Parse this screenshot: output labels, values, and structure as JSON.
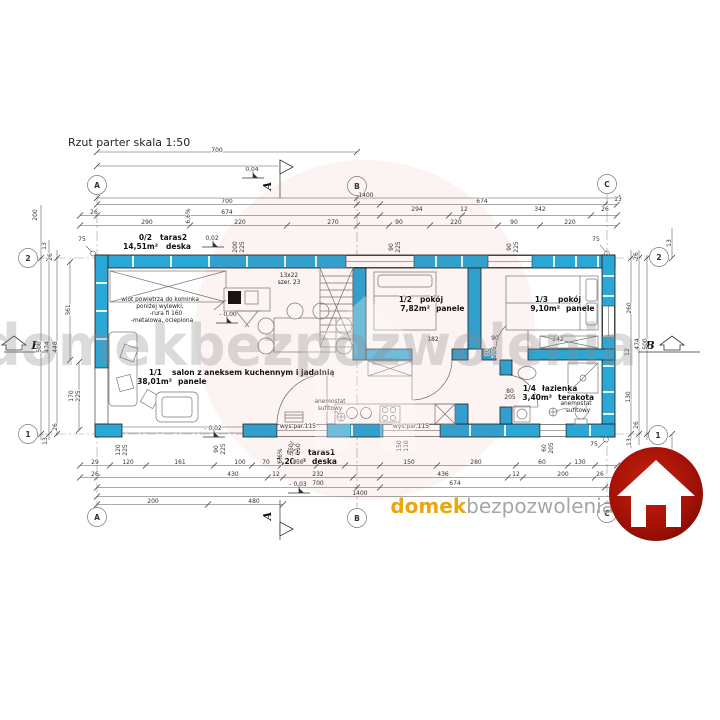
{
  "title": "Rzut parter skala 1:50",
  "watermark": {
    "text": "domekbezpozwolenia"
  },
  "logo": {
    "brand_orange": "domek",
    "brand_gray": "bezpozwolenia"
  },
  "colors": {
    "wall": "#2BA7D6",
    "logo_red": "#A31106",
    "brand_orange": "#E9A712",
    "brand_gray": "#A6A6A6"
  },
  "axes": {
    "a": "A",
    "b": "B",
    "c": "C",
    "one": "1",
    "two": "2",
    "section": "A",
    "side": "B"
  },
  "rooms": [
    {
      "id": "0/2",
      "name": "taras2",
      "area": "14,51m²",
      "floor": "deska"
    },
    {
      "id": "1/1",
      "name": "salon z aneksem kuchennym i jadalnią",
      "area": "38,01m²",
      "floor": "panele"
    },
    {
      "id": "1/2",
      "name": "pokój",
      "area": "7,82m²",
      "floor": "panele"
    },
    {
      "id": "1/3",
      "name": "pokój",
      "area": "9,10m²",
      "floor": "panele"
    },
    {
      "id": "1/4",
      "name": "łazienka",
      "area": "3,40m²",
      "floor": "terakota"
    },
    {
      "id": "0/1",
      "name": "taras1",
      "area": "7,20m²",
      "floor": "deska"
    }
  ],
  "annotations": {
    "fireplace_note": [
      "wlot powietrza do kominka",
      "poniżej wylewki,",
      "-rura fi 160",
      "-metalowa, ocieplona"
    ],
    "stairs_line1": "13x22",
    "stairs_line2": "szer. 23",
    "anemostat_line1": "anemostat",
    "anemostat_line2": "sufitowy",
    "elevations": {
      "e1": "0,04",
      "e2": "0,02",
      "e3": "- 0,00",
      "e4": "- 0,02",
      "e5": "- 0,03"
    }
  },
  "dimensions": {
    "top": [
      [
        "700",
        217,
        152,
        0
      ],
      [
        "1400",
        366,
        197,
        0
      ],
      [
        "700",
        227,
        203,
        0
      ],
      [
        "674",
        482,
        203,
        0
      ],
      [
        "13",
        618,
        201,
        0
      ],
      [
        "26",
        94,
        214,
        0
      ],
      [
        "674",
        227,
        214,
        0
      ],
      [
        "294",
        417,
        211,
        0
      ],
      [
        "12",
        464,
        211,
        0
      ],
      [
        "342",
        540,
        211,
        0
      ],
      [
        "26",
        605,
        211,
        0
      ],
      [
        "290",
        147,
        224,
        0
      ],
      [
        "220",
        240,
        224,
        0
      ],
      [
        "270",
        333,
        224,
        0
      ],
      [
        "90",
        399,
        224,
        0
      ],
      [
        "220",
        456,
        224,
        0
      ],
      [
        "90",
        514,
        224,
        0
      ],
      [
        "220",
        570,
        224,
        0
      ],
      [
        "6,6%",
        190,
        216,
        1
      ],
      [
        "200",
        237,
        247,
        1
      ],
      [
        "225",
        244,
        247,
        1
      ],
      [
        "90",
        393,
        247,
        1
      ],
      [
        "225",
        400,
        247,
        1
      ],
      [
        "90",
        511,
        247,
        1
      ],
      [
        "225",
        518,
        247,
        1
      ],
      [
        "75",
        596,
        241,
        0
      ],
      [
        "75",
        82,
        241,
        0
      ]
    ],
    "left": [
      [
        "200",
        37,
        215,
        1
      ],
      [
        "13",
        46,
        246,
        1
      ],
      [
        "26",
        52,
        257,
        1
      ],
      [
        "361",
        70,
        310,
        1
      ],
      [
        "500",
        41,
        347,
        1
      ],
      [
        "474",
        49,
        347,
        1
      ],
      [
        "448",
        57,
        347,
        1
      ],
      [
        "170",
        73,
        396,
        1
      ],
      [
        "225",
        80,
        396,
        1
      ],
      [
        "26",
        57,
        427,
        1
      ],
      [
        "13",
        47,
        441,
        1
      ]
    ],
    "right": [
      [
        "13",
        671,
        243,
        1
      ],
      [
        "26",
        638,
        256,
        1
      ],
      [
        "260",
        631,
        308,
        1
      ],
      [
        "12",
        629,
        352,
        1
      ],
      [
        "474",
        639,
        344,
        1
      ],
      [
        "500",
        647,
        344,
        1
      ],
      [
        "130",
        630,
        397,
        1
      ],
      [
        "26",
        638,
        425,
        1
      ],
      [
        "13",
        631,
        442,
        1
      ],
      [
        "75",
        594,
        446,
        0
      ]
    ],
    "bottom": [
      [
        "wys.par.115",
        298,
        428,
        0
      ],
      [
        "wys.par.115",
        411,
        428,
        0
      ],
      [
        "120",
        120,
        450,
        1
      ],
      [
        "225",
        127,
        450,
        1
      ],
      [
        "90",
        218,
        449,
        1
      ],
      [
        "225",
        225,
        449,
        1
      ],
      [
        "150",
        293,
        449,
        1
      ],
      [
        "110",
        300,
        449,
        1
      ],
      [
        "6,6%",
        282,
        456,
        1
      ],
      [
        "150",
        401,
        446,
        1
      ],
      [
        "110",
        408,
        446,
        1
      ],
      [
        "60",
        546,
        448,
        1
      ],
      [
        "205",
        553,
        448,
        1
      ],
      [
        "29",
        95,
        464,
        0
      ],
      [
        "120",
        128,
        464,
        0
      ],
      [
        "161",
        180,
        464,
        0
      ],
      [
        "100",
        240,
        464,
        0
      ],
      [
        "70",
        266,
        464,
        0
      ],
      [
        "150",
        298,
        464,
        0
      ],
      [
        "150",
        409,
        464,
        0
      ],
      [
        "280",
        476,
        464,
        0
      ],
      [
        "60",
        542,
        464,
        0
      ],
      [
        "130",
        580,
        464,
        0
      ],
      [
        "26",
        95,
        476,
        0
      ],
      [
        "430",
        233,
        476,
        0
      ],
      [
        "12",
        276,
        476,
        0
      ],
      [
        "232",
        318,
        476,
        0
      ],
      [
        "436",
        443,
        476,
        0
      ],
      [
        "12",
        516,
        476,
        0
      ],
      [
        "200",
        563,
        476,
        0
      ],
      [
        "26",
        600,
        476,
        0
      ],
      [
        "700",
        318,
        485,
        0
      ],
      [
        "674",
        455,
        485,
        0
      ],
      [
        "13",
        617,
        486,
        0
      ],
      [
        "1400",
        360,
        495,
        0
      ],
      [
        "200",
        153,
        503,
        0
      ],
      [
        "480",
        254,
        503,
        0
      ]
    ],
    "interior": [
      [
        "182",
        433,
        341,
        0
      ],
      [
        "90",
        495,
        340,
        0
      ],
      [
        "242",
        558,
        341,
        0
      ],
      [
        "80",
        489,
        352,
        1
      ],
      [
        "205",
        496,
        352,
        1
      ],
      [
        "80",
        510,
        393,
        0
      ],
      [
        "205",
        510,
        399,
        0
      ]
    ]
  }
}
